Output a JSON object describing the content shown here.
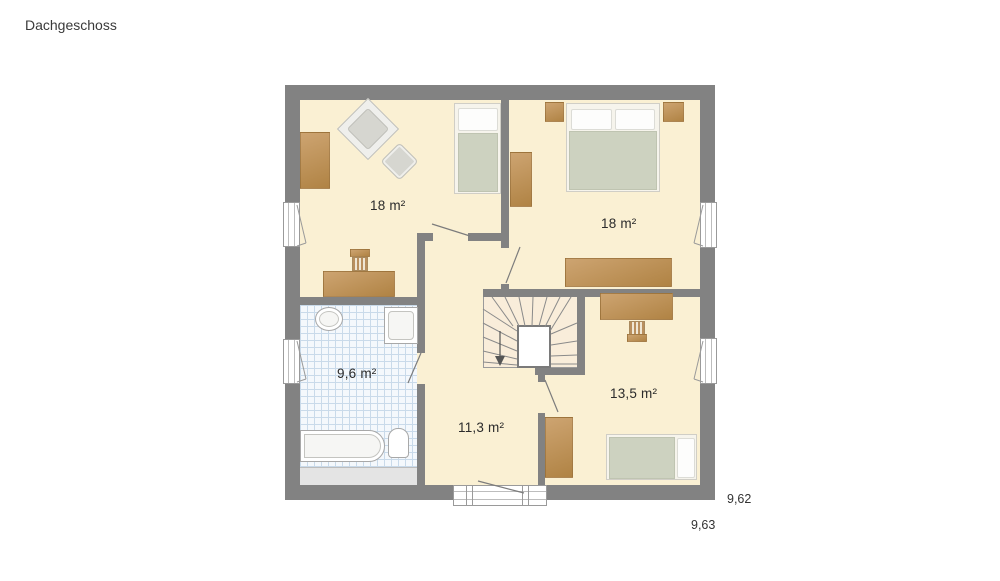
{
  "title": "Dachgeschoss",
  "rooms": [
    {
      "id": "bedroom-top-left",
      "area": "18 m²",
      "furniture": [
        "wardrobe",
        "armchair",
        "ottoman",
        "single-bed",
        "desk",
        "chair"
      ]
    },
    {
      "id": "bedroom-top-right",
      "area": "18 m²",
      "furniture": [
        "nightstand",
        "double-bed",
        "nightstand",
        "wardrobe",
        "sideboard"
      ]
    },
    {
      "id": "bathroom",
      "area": "9,6 m²",
      "furniture": [
        "washbasin",
        "shower",
        "bathtub",
        "toilet"
      ]
    },
    {
      "id": "hallway",
      "area": "11,3 m²",
      "furniture": [
        "staircase",
        "balcony-window"
      ]
    },
    {
      "id": "bedroom-bottom-right",
      "area": "13,5 m²",
      "furniture": [
        "desk",
        "chair",
        "wardrobe",
        "single-bed"
      ]
    }
  ],
  "dimensions": {
    "right_upper": "9,62",
    "right_lower": "9,63"
  },
  "colors": {
    "wall": "#828282",
    "floor": "#faf0d3",
    "stair_floor": "#f9edda",
    "wood_light": "#cda471",
    "wood_dark": "#b08344",
    "mattress": "#cdd2c0",
    "pillow": "#fdfdfc",
    "tile_bg": "#f4f8fc",
    "tile_line": "#c9daea",
    "knee": "#e4e4e4",
    "text": "#2e2e2e"
  }
}
